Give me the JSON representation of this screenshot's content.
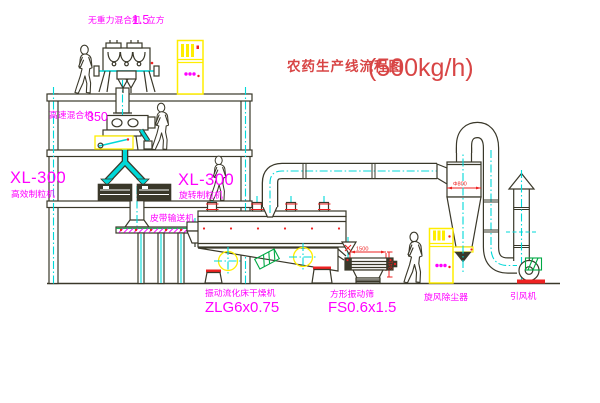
{
  "colors": {
    "ink": "#3a382a",
    "cyan": "#00d8d8",
    "yellow": "#ffee00",
    "magenta": "#ff00ff",
    "red-title": "#d84545",
    "red-dim": "#ee2222",
    "green": "#00a844"
  },
  "title": {
    "text": "农药生产线流程图",
    "capacity": "(500kg/h)"
  },
  "labels": {
    "gravity_mixer_name": "无重力混合机",
    "gravity_mixer_size": "1.5",
    "gravity_mixer_unit": "立方",
    "high_speed_mixer_name": "高速混合机",
    "high_speed_mixer_size": "350",
    "granulator_left_model": "XL-300",
    "granulator_left_name": "高效制粒机",
    "granulator_right_model": "XL-300",
    "granulator_right_name": "旋转制粒机",
    "belt_conveyor": "皮带输送机",
    "dryer_name": "振动流化床干燥机",
    "dryer_model": "ZLG6x0.75",
    "screen_name": "方形振动筛",
    "screen_model": "FS0.6x1.5",
    "cyclone_name": "旋风除尘器",
    "fan_name": "引风机"
  },
  "dimensions": {
    "screen_length": "1500",
    "screen_height": "341",
    "cyclone_inlet": "Φ800"
  }
}
